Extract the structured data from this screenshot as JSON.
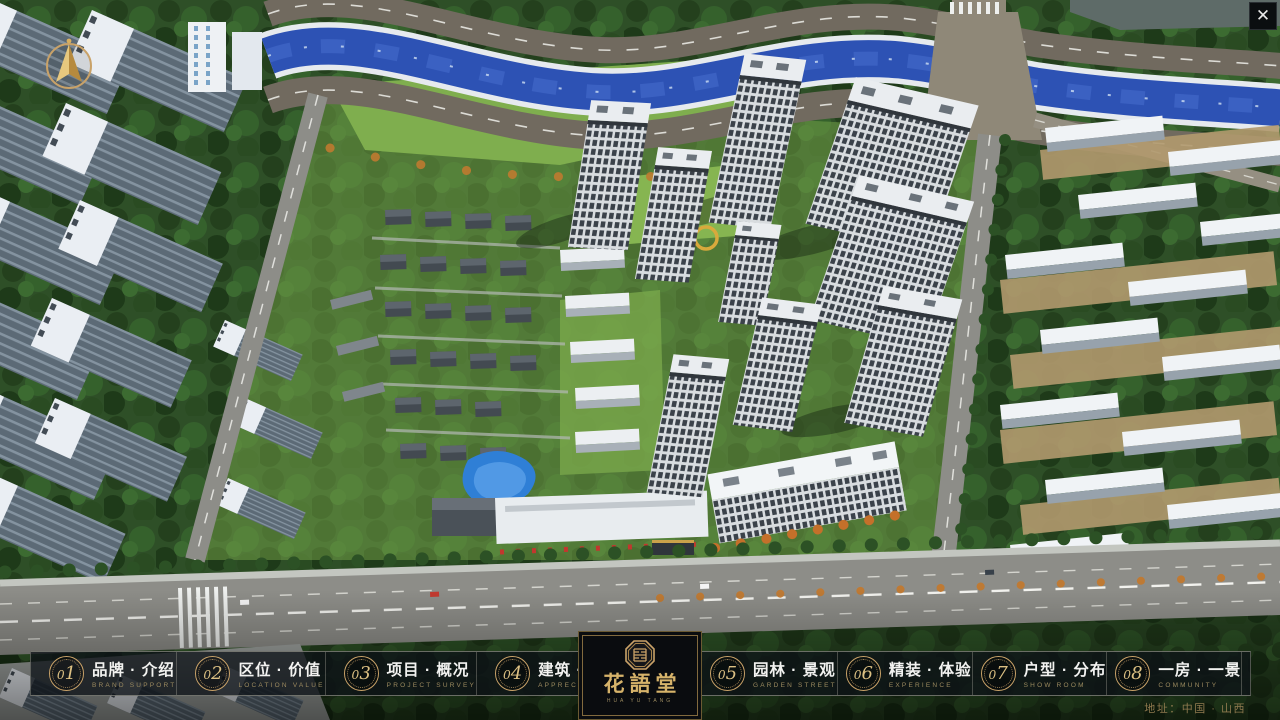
{
  "app": {
    "close_glyph": "✕"
  },
  "nav": {
    "items": [
      {
        "num": "01",
        "label": "品牌 · 介绍",
        "sub": "BRAND SUPPORT"
      },
      {
        "num": "02",
        "label": "区位 · 价值",
        "sub": "LOCATION VALUE"
      },
      {
        "num": "03",
        "label": "项目 · 概况",
        "sub": "PROJECT SURVEY"
      },
      {
        "num": "04",
        "label": "建筑 · 鉴赏",
        "sub": "APPRECIATION"
      },
      {
        "num": "05",
        "label": "园林 · 景观",
        "sub": "GARDEN STREET"
      },
      {
        "num": "06",
        "label": "精装 · 体验",
        "sub": "EXPERIENCE"
      },
      {
        "num": "07",
        "label": "户型 · 分布",
        "sub": "SHOW ROOM"
      },
      {
        "num": "08",
        "label": "一房 · 一景",
        "sub": "COMMUNITY"
      }
    ]
  },
  "logo": {
    "title": "花語堂",
    "subtitle": "HUA YU TANG"
  },
  "footer": {
    "address": "地址：中国 · 山西"
  },
  "colors": {
    "accent_gold": "#c9a268",
    "bar_bg": "rgba(13,18,24,0.76)",
    "river_blue": "#2d52b4",
    "lawn_green": "#7fae4e",
    "forest_green": "#2e4f27",
    "road_grey": "#8d8d88",
    "tower_white": "#eaedf0"
  }
}
